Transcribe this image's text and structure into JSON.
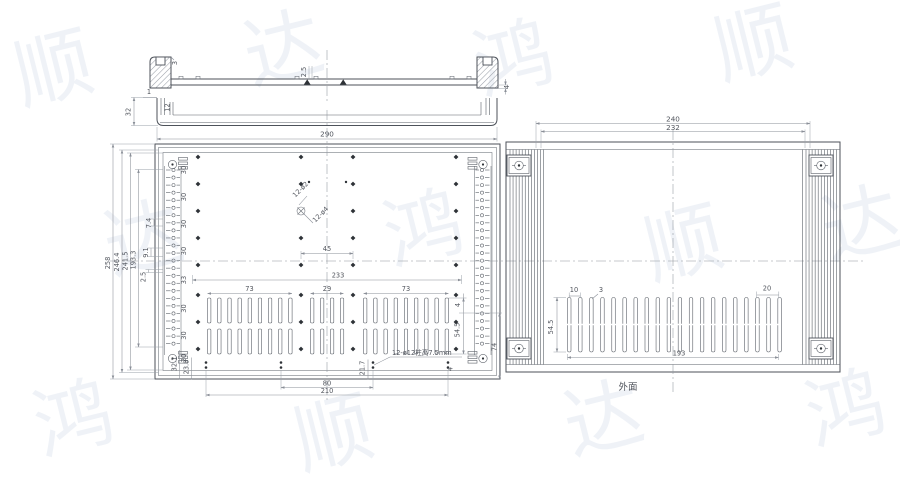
{
  "watermark": {
    "chars": [
      "顺",
      "达",
      "鸿"
    ]
  },
  "section_view": {
    "wall_thk": "3",
    "web_thk": "2.5",
    "flange_thk": "4"
  },
  "channel_view": {
    "lip": "1",
    "depth": "12",
    "height": "32"
  },
  "inside_view": {
    "width": "290",
    "heights": [
      "258",
      "246.4",
      "241.5",
      "193.3"
    ],
    "side_small": [
      "7.4",
      "9.1",
      "2.5"
    ],
    "row_spacings": [
      "30",
      "30",
      "30",
      "30",
      "33",
      "30",
      "30",
      "20"
    ],
    "hole_note_small": "12-ø2",
    "hole_note_big": "12-ø4",
    "pitch45": "45",
    "span233": "233",
    "groups": [
      "73",
      "29",
      "73"
    ],
    "slot4": "4",
    "slot_h": "54.5",
    "off74": "74",
    "corner": [
      "32.1",
      "23.8",
      "21.7",
      "4"
    ],
    "boss_note": "12-ø12柱高7.5mm",
    "b80": "80",
    "b210": "210"
  },
  "outside_view": {
    "d240": "240",
    "d232": "232",
    "p10": "10",
    "w3": "3",
    "p20": "20",
    "h545": "54.5",
    "s193": "193",
    "face": "外面"
  }
}
